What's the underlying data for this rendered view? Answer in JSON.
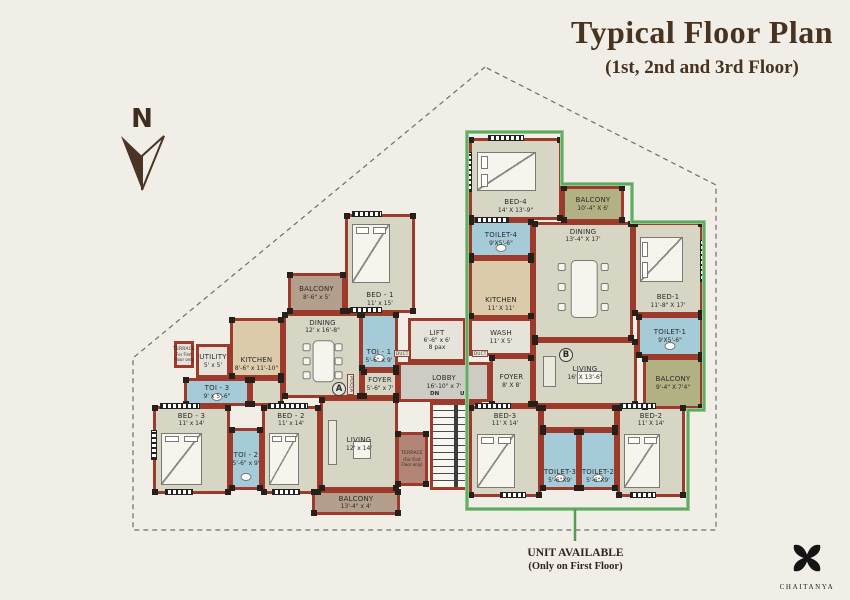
{
  "title": {
    "main": "Typical Floor Plan",
    "sub": "(1st, 2nd and 3rd Floor)"
  },
  "north": {
    "label": "N"
  },
  "legend": {
    "line1": "UNIT AVAILABLE",
    "line2": "(Only on First Floor)"
  },
  "brand": {
    "name": "CHAITANYA",
    "icon": "four-petal-flower-logo"
  },
  "units": {
    "a": "A",
    "b": "B"
  },
  "colors": {
    "paper": "#f1eee7",
    "wall": "#9c3a2c",
    "room_floor": "#d7d6c5",
    "kitchen_floor": "#dbcbab",
    "toilet_floor": "#a6cbd8",
    "balcony_olive": "#b2b183",
    "balcony_brown": "#b49e8c",
    "terrace": "#b38577",
    "lobby": "#ccccc5",
    "highlight_green": "#549c54",
    "title_brown": "#47331f"
  },
  "rooms": [
    {
      "name": "bed-1-a",
      "label": "BED - 1",
      "dims": "11' x 15'",
      "x": 345,
      "y": 214,
      "w": 70,
      "h": 99,
      "floor": "room",
      "furn": "bed-v",
      "labelPos": "bottom"
    },
    {
      "name": "balcony-top-a",
      "label": "BALCONY",
      "dims": "8'-6\" x 5'",
      "x": 288,
      "y": 273,
      "w": 57,
      "h": 40,
      "floor": "balc-brown"
    },
    {
      "name": "dining-a",
      "label": "DINING",
      "dims": "12' x 16'-8\"",
      "x": 283,
      "y": 313,
      "w": 79,
      "h": 85,
      "floor": "room",
      "furn": "table",
      "labelPos": "top"
    },
    {
      "name": "kitchen-a",
      "label": "KITCHEN",
      "dims": "8'-6\" x 11'-10\"",
      "x": 230,
      "y": 318,
      "w": 53,
      "h": 60,
      "floor": "kitchen",
      "labelPos": "bottom"
    },
    {
      "name": "utility-a",
      "label": "UTILITY",
      "dims": "5' x 5'",
      "x": 196,
      "y": 344,
      "w": 34,
      "h": 34,
      "floor": "light"
    },
    {
      "name": "terrace-small-a",
      "label": "TERRACE",
      "dims": "For First Floor only",
      "x": 174,
      "y": 341,
      "w": 20,
      "h": 27,
      "floor": "light",
      "tiny": true
    },
    {
      "name": "toi-3-a",
      "label": "TOI - 3",
      "dims": "9' x 5'-6\"",
      "x": 184,
      "y": 378,
      "w": 66,
      "h": 28,
      "floor": "toilet",
      "furn": "wc"
    },
    {
      "name": "bed-3-a",
      "label": "BED - 3",
      "dims": "11' x 14'",
      "x": 153,
      "y": 406,
      "w": 77,
      "h": 88,
      "floor": "room",
      "furn": "bed-v",
      "labelPos": "top"
    },
    {
      "name": "toi-2-a",
      "label": "TOI - 2",
      "dims": "5'-6\" x 9'",
      "x": 230,
      "y": 428,
      "w": 32,
      "h": 62,
      "floor": "toilet",
      "furn": "wc"
    },
    {
      "name": "bed-2-a",
      "label": "BED - 2",
      "dims": "11' x 14'",
      "x": 262,
      "y": 406,
      "w": 58,
      "h": 88,
      "floor": "room",
      "furn": "bed-v",
      "labelPos": "top"
    },
    {
      "name": "toi-1-a",
      "label": "TOI - 1",
      "dims": "5'-6\" x 9'",
      "x": 360,
      "y": 313,
      "w": 38,
      "h": 57,
      "floor": "toilet",
      "furn": "wc",
      "labelPos": "bottom"
    },
    {
      "name": "foyer-a",
      "label": "FOYER",
      "dims": "5'-6\" x 7'",
      "x": 362,
      "y": 370,
      "w": 36,
      "h": 28,
      "floor": "room"
    },
    {
      "name": "passage-a",
      "x": 250,
      "y": 378,
      "w": 33,
      "h": 28,
      "floor": "room"
    },
    {
      "name": "living-a",
      "label": "LIVING",
      "dims": "12' x 14'",
      "x": 320,
      "y": 398,
      "w": 78,
      "h": 92,
      "floor": "room",
      "furn": "sofa"
    },
    {
      "name": "terrace-a",
      "label": "TERRACE",
      "dims": "(For First Floor only)",
      "x": 396,
      "y": 432,
      "w": 32,
      "h": 54,
      "floor": "terrace",
      "tiny": true
    },
    {
      "name": "balcony-bottom-a",
      "label": "BALCONY",
      "dims": "13'-4\" x 4'",
      "x": 312,
      "y": 490,
      "w": 88,
      "h": 25,
      "floor": "balc-brown"
    },
    {
      "name": "lift",
      "label": "LIFT",
      "dims": "6'-6\" x 6'",
      "extra": "8 pax",
      "x": 408,
      "y": 318,
      "w": 58,
      "h": 44,
      "floor": "light"
    },
    {
      "name": "lobby",
      "label": "LOBBY",
      "dims": "16'-10\" x 7'",
      "x": 398,
      "y": 362,
      "w": 92,
      "h": 40,
      "floor": "lobby"
    },
    {
      "name": "stairs",
      "x": 430,
      "y": 402,
      "w": 52,
      "h": 88,
      "floor": "stairs"
    },
    {
      "name": "bed-4-b",
      "label": "BED-4",
      "dims": "14' X 13'-9\"",
      "x": 469,
      "y": 138,
      "w": 93,
      "h": 82,
      "floor": "room",
      "furn": "bed-h",
      "labelPos": "bottom"
    },
    {
      "name": "balcony-top-b",
      "label": "BALCONY",
      "dims": "10'-4\" X 6'",
      "x": 562,
      "y": 186,
      "w": 62,
      "h": 36,
      "floor": "balc-olive"
    },
    {
      "name": "toilet-4-b",
      "label": "TOILET-4",
      "dims": "9'X5'-6\"",
      "x": 469,
      "y": 220,
      "w": 64,
      "h": 38,
      "floor": "toilet",
      "furn": "wc"
    },
    {
      "name": "dining-b",
      "label": "DINING",
      "dims": "13'-4\" X 17'",
      "x": 533,
      "y": 222,
      "w": 100,
      "h": 118,
      "floor": "room",
      "furn": "table",
      "labelPos": "top"
    },
    {
      "name": "kitchen-b",
      "label": "KITCHEN",
      "dims": "11' X 11'",
      "x": 469,
      "y": 258,
      "w": 64,
      "h": 60,
      "floor": "kitchen",
      "labelPos": "bottom"
    },
    {
      "name": "bed-1-b",
      "label": "BED-1",
      "dims": "11'-8\" X 17'",
      "x": 633,
      "y": 222,
      "w": 70,
      "h": 93,
      "floor": "room",
      "furn": "bed-h",
      "labelPos": "bottom"
    },
    {
      "name": "wash-b",
      "label": "WASH",
      "dims": "11' X 5'",
      "x": 469,
      "y": 318,
      "w": 64,
      "h": 38,
      "floor": "light"
    },
    {
      "name": "toilet-1-b",
      "label": "TOILET-1",
      "dims": "9'X5'-6\"",
      "x": 637,
      "y": 315,
      "w": 66,
      "h": 42,
      "floor": "toilet",
      "furn": "wc"
    },
    {
      "name": "balcony-right-b",
      "label": "BALCONY",
      "dims": "9'-4\" X 7'4\"",
      "x": 643,
      "y": 357,
      "w": 60,
      "h": 52,
      "floor": "balc-olive"
    },
    {
      "name": "living-b",
      "label": "LIVING",
      "dims": "16' X 13'-6\"",
      "x": 533,
      "y": 340,
      "w": 104,
      "h": 66,
      "floor": "room",
      "furn": "sofa"
    },
    {
      "name": "foyer-b",
      "label": "FOYER",
      "dims": "8' X 8'",
      "x": 490,
      "y": 356,
      "w": 43,
      "h": 50,
      "floor": "room"
    },
    {
      "name": "bed-3-b",
      "label": "BED-3",
      "dims": "11' X 14'",
      "x": 469,
      "y": 406,
      "w": 72,
      "h": 91,
      "floor": "room",
      "furn": "bed-v",
      "labelPos": "top"
    },
    {
      "name": "passage-b",
      "x": 541,
      "y": 406,
      "w": 76,
      "h": 24,
      "floor": "room"
    },
    {
      "name": "toilet-3-b",
      "label": "TOILET-3",
      "dims": "5'-6\"X9'",
      "x": 541,
      "y": 430,
      "w": 38,
      "h": 60,
      "floor": "toilet",
      "furn": "wc",
      "labelPos": "bottom"
    },
    {
      "name": "toilet-2-b",
      "label": "TOILET-2",
      "dims": "5'-6\"X9'",
      "x": 579,
      "y": 430,
      "w": 38,
      "h": 60,
      "floor": "toilet",
      "furn": "wc",
      "labelPos": "bottom"
    },
    {
      "name": "bed-2-b",
      "label": "BED-2",
      "dims": "11' X 14'",
      "x": 617,
      "y": 406,
      "w": 68,
      "h": 91,
      "floor": "room",
      "furn": "bed-v",
      "labelPos": "top"
    }
  ],
  "free_labels": [
    {
      "name": "unit-a-marker",
      "text": "A",
      "x": 332,
      "y": 382,
      "cls": "circle"
    },
    {
      "name": "unit-b-marker",
      "text": "B",
      "x": 559,
      "y": 348,
      "cls": "circle"
    },
    {
      "name": "stairs-dn-label",
      "text": "DN",
      "x": 430,
      "y": 391,
      "cls": "stair"
    },
    {
      "name": "stairs-up-label",
      "text": "UP",
      "x": 460,
      "y": 391,
      "cls": "stair"
    },
    {
      "name": "duct-left-label",
      "text": "DUCT",
      "x": 394,
      "y": 350,
      "cls": "duct"
    },
    {
      "name": "duct-right-label",
      "text": "DUCT",
      "x": 472,
      "y": 350,
      "cls": "duct"
    },
    {
      "name": "pooja-label",
      "text": "POOJA",
      "x": 347,
      "y": 374,
      "cls": "vert"
    }
  ],
  "windows": [
    {
      "x": 352,
      "y": 211,
      "w": 30,
      "h": 6,
      "dir": "h"
    },
    {
      "x": 350,
      "y": 307,
      "w": 32,
      "h": 6,
      "dir": "h"
    },
    {
      "x": 160,
      "y": 403,
      "w": 40,
      "h": 6,
      "dir": "h"
    },
    {
      "x": 268,
      "y": 403,
      "w": 40,
      "h": 6,
      "dir": "h"
    },
    {
      "x": 165,
      "y": 489,
      "w": 28,
      "h": 6,
      "dir": "h"
    },
    {
      "x": 272,
      "y": 489,
      "w": 28,
      "h": 6,
      "dir": "h"
    },
    {
      "x": 151,
      "y": 430,
      "w": 6,
      "h": 30,
      "dir": "v"
    },
    {
      "x": 488,
      "y": 135,
      "w": 36,
      "h": 6,
      "dir": "h"
    },
    {
      "x": 466,
      "y": 152,
      "w": 6,
      "h": 40,
      "dir": "v"
    },
    {
      "x": 475,
      "y": 217,
      "w": 34,
      "h": 6,
      "dir": "h"
    },
    {
      "x": 700,
      "y": 240,
      "w": 6,
      "h": 42,
      "dir": "v"
    },
    {
      "x": 475,
      "y": 403,
      "w": 36,
      "h": 6,
      "dir": "h"
    },
    {
      "x": 620,
      "y": 403,
      "w": 36,
      "h": 6,
      "dir": "h"
    },
    {
      "x": 500,
      "y": 492,
      "w": 26,
      "h": 6,
      "dir": "h"
    },
    {
      "x": 630,
      "y": 492,
      "w": 26,
      "h": 6,
      "dir": "h"
    }
  ],
  "overlay": {
    "boundary_points": "485,67 133,358 133,530 716,530 716,185",
    "highlight_points": "467,132 562,132 562,184 632,184 632,222 704,222 704,410 688,410 688,509 467,509",
    "connector": {
      "x1": 575,
      "y1": 509,
      "x2": 575,
      "y2": 541
    }
  }
}
